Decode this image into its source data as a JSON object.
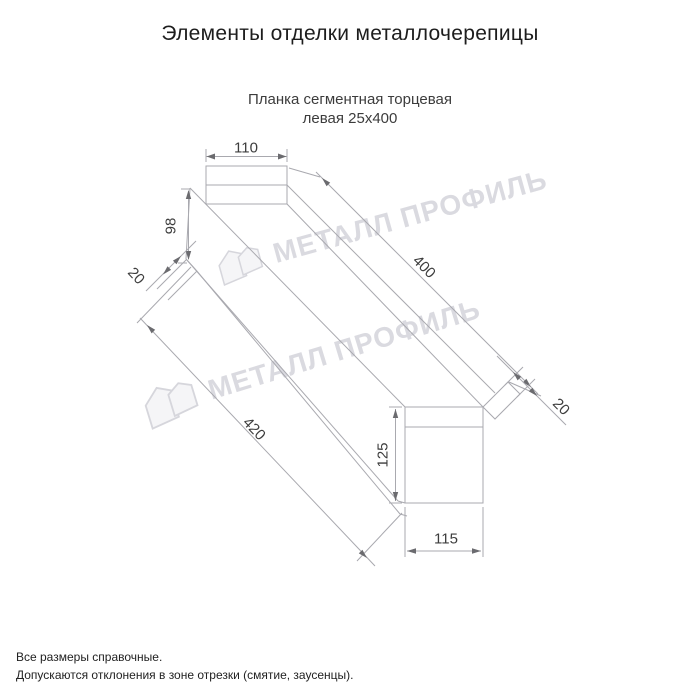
{
  "page": {
    "title": "Элементы отделки металлочерепицы",
    "product": {
      "line1": "Планка сегментная торцевая",
      "line2": "левая 25х400"
    }
  },
  "drawing": {
    "dimensions": {
      "top_flange_width": "110",
      "left_web_height": "98",
      "left_fold": "20",
      "top_length": "400",
      "bottom_length": "420",
      "right_fold": "20",
      "right_web_height": "125",
      "bottom_flange_width": "115"
    },
    "watermark_text": "МЕТАЛЛ ПРОФИЛЬ"
  },
  "footer": {
    "note1": "Все размеры справочные.",
    "note2": "Допускаются отклонения в зоне отрезки (смятие, заусенцы)."
  },
  "colors": {
    "drawing_line": "#a9a9af",
    "dim_text": "#3d3d3d",
    "watermark": "#cbcbd3",
    "title_text": "#1d1d1d"
  }
}
